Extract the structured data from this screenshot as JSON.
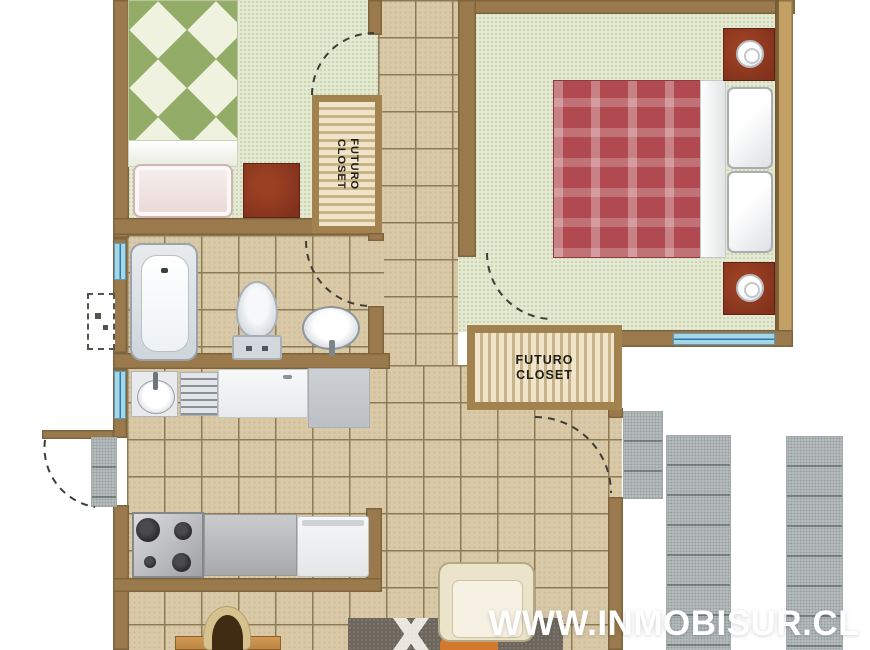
{
  "watermark": {
    "text": "WWW.INMOBISUR.CL"
  },
  "closets": {
    "closet1": {
      "line1": "FUTURO",
      "line2": "CLOSET"
    },
    "closet2": {
      "line1": "FUTURO",
      "line2": "CLOSET"
    }
  },
  "colors": {
    "wall": "#9a7a4c",
    "wall-light": "#c2a064",
    "tile-floor": "#d9c9a7",
    "tile-grid": "#8d7b55",
    "green-floor": "#e4e9d2",
    "bed1-diamond": "#93ad68",
    "bed2-plaid": "#b04a50",
    "nightstand": "#82321c",
    "closet-frame": "#a2824f",
    "window-glass": "#a6d7e8",
    "paver": "#bac1c0",
    "rug": "#6d665c",
    "rug-accent": "#d97a2a",
    "armchair": "#ebe3ca",
    "wood": "#bc8442",
    "watermark": "#ffffff"
  }
}
